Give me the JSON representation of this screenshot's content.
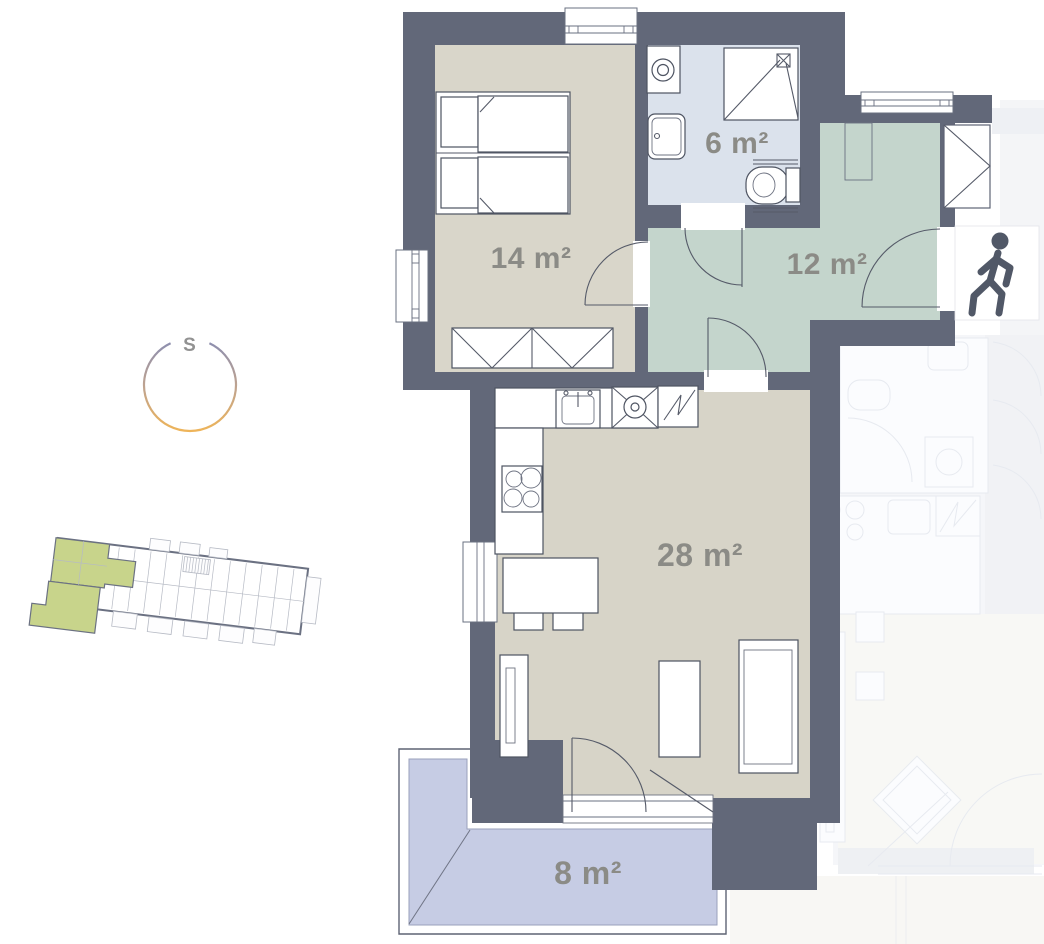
{
  "floorplan": {
    "unit_rooms": [
      {
        "id": "bedroom",
        "label": "14 m²",
        "floor_color": "#d9d6ca"
      },
      {
        "id": "bathroom",
        "label": "6 m²",
        "floor_color": "#dbe2ec"
      },
      {
        "id": "hallway",
        "label": "12 m²",
        "floor_color": "#c4d5cc"
      },
      {
        "id": "living_kitchen",
        "label": "28 m²",
        "floor_color": "#d7d4c8"
      },
      {
        "id": "terrace",
        "label": "8 m²",
        "floor_color": "#c6cce4"
      }
    ],
    "compass": {
      "label": "S",
      "gradient_top": "#8e8fae",
      "gradient_bottom": "#eeb459"
    },
    "colors": {
      "wall": "#626879",
      "label_text": "#8b8b86",
      "person_icon": "#515867",
      "site_plan_highlight": "#c8d48b",
      "faded_neighbor": "#f5f6f9"
    },
    "icons": {
      "walking-person-icon": "entrance marker",
      "compass-icon": "orientation ring",
      "bed-icon": "double bed",
      "wardrobe-icon": "wardrobe",
      "washing-machine-icon": "washing machine",
      "bath-sink-icon": "wash basin",
      "shower-icon": "shower",
      "toilet-icon": "toilet",
      "kitchen-sink-icon": "kitchen sink",
      "stove-icon": "oven",
      "fridge-icon": "refrigerator",
      "cooktop-icon": "cooktop",
      "sofa-icon": "sofa",
      "closet-icon": "entry closet"
    }
  }
}
